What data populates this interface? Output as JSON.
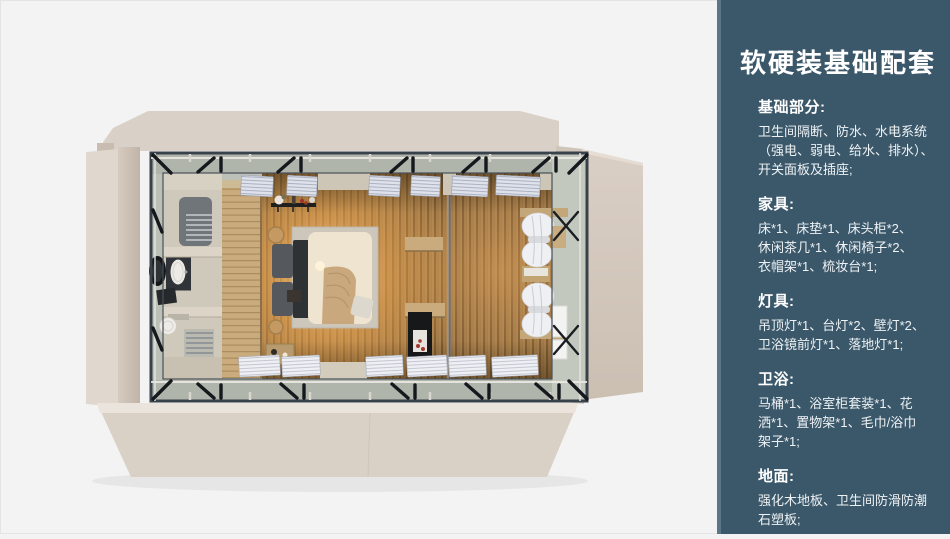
{
  "sidebar": {
    "title": "软硬装基础配套",
    "panel_color": "#3b586b",
    "edge_color": "#5d7686",
    "text_color": "#ffffff",
    "sections": [
      {
        "heading": "基础部分:",
        "lines": [
          "卫生间隔断、防水、水电系统",
          "（强电、弱电、给水、排水）、",
          "开关面板及插座;"
        ]
      },
      {
        "heading": "家具:",
        "lines": [
          "床*1、床垫*1、床头柜*2、",
          "休闲茶几*1、休闲椅子*2、",
          "衣帽架*1、梳妆台*1;"
        ]
      },
      {
        "heading": "灯具:",
        "lines": [
          "吊顶灯*1、台灯*2、壁灯*2、",
          "卫浴镜前灯*1、落地灯*1;"
        ]
      },
      {
        "heading": "卫浴:",
        "lines": [
          "马桶*1、浴室柜套装*1、花",
          "洒*1、置物架*1、毛巾/浴巾",
          "架子*1;"
        ]
      },
      {
        "heading": "地面:",
        "lines": [
          "强化木地板、卫生间防滑防潮",
          "石塑板;"
        ]
      }
    ]
  },
  "floorplan": {
    "palette": {
      "exterior_wall": "#dbd2c8",
      "steel_frame": "#39414b",
      "wood_floor": "#a57e4c",
      "warm_glow": "#f2ae5e",
      "bathroom_tile": "#cfc9bb",
      "blinds": "#dfe2ea",
      "page_background": "#f2f3f2"
    }
  }
}
